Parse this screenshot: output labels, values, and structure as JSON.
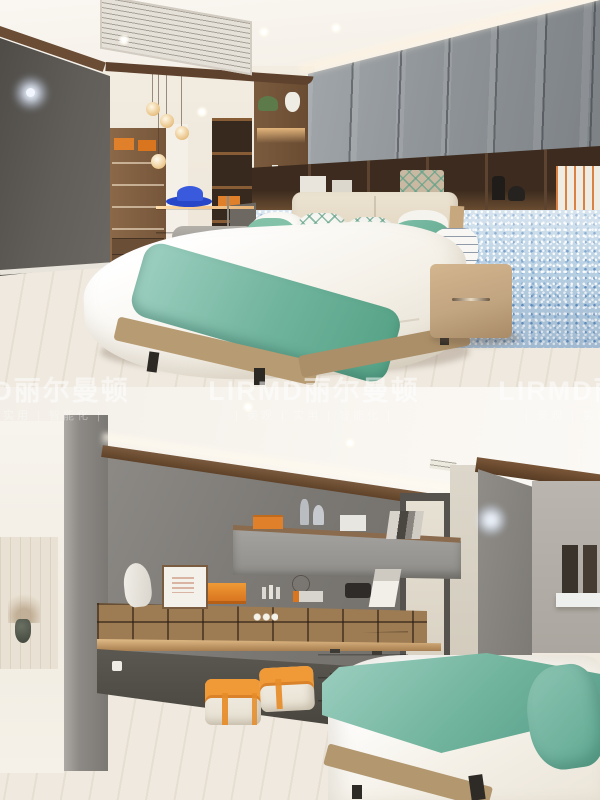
{
  "canvas": {
    "width": 600,
    "height": 800
  },
  "watermark": {
    "brand": "LIRMD丽尔曼顿",
    "tagline": "| 美观 | 实用 | 智能化 |",
    "color": "#ffffff"
  },
  "photos": {
    "top": {
      "label": "bedroom showroom: grey wardrobe wall, walnut display shelf, blue sparkle mosaic half-wall, bed with white duvet and teal runner, leather nightstand, walk-in closet with pendant globe lights and orange boxes"
    },
    "bottom": {
      "label": "bedroom study corner: grey feature wall, floating cabinet, walnut desk with cubby shelving, two orange-striped pouf stools, sage drawer unit, bed with teal blanket, bright side room with vase"
    }
  },
  "palette": {
    "teal": "#6fb39c",
    "teal_light": "#9dcfc0",
    "orange": "#e0802a",
    "mosaic_blue": "#b7cfe2",
    "wood": "#8a6848",
    "walnut_dark": "#3c2b1e",
    "cabinet_gray": "#8f9498",
    "wall_gray": "#7f7c78",
    "floor_wood": "#e9e1d2",
    "sage_green": "#8d9383",
    "tan_leather": "#c2a581",
    "hat_blue": "#2847c8"
  }
}
